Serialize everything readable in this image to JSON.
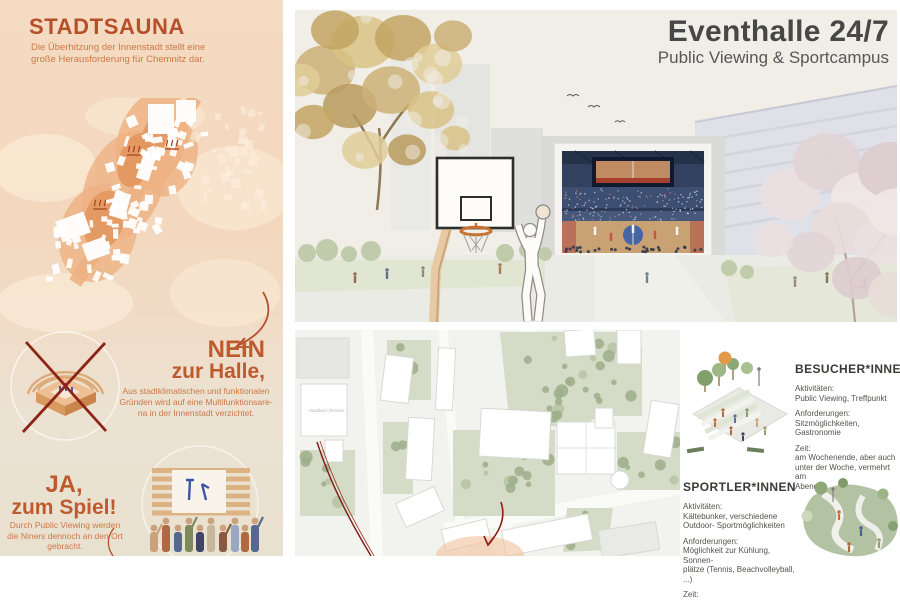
{
  "colors": {
    "accent_rust": "#b5502a",
    "accent_rust_light": "#cc7848",
    "cross_red": "#8c2417",
    "route_red": "#7d1a12",
    "title_gray": "#474747",
    "peach_background": "#f4d9c0",
    "sage_green": "#b3c2a3"
  },
  "left_panel": {
    "title": "STADTSAUNA",
    "subtitle_lines": [
      "Die Überhitzung der Innenstadt stellt eine",
      "große Herausforderung für Chemnitz dar."
    ],
    "nein": {
      "heading_line1": "NEIN",
      "heading_line2": "zur Halle,",
      "body_lines": [
        "Aus stadtklimatischen und funktionalen",
        "Gründen wird auf eine Multifunktionsare-",
        "na in der Innenstadt verzichtet."
      ]
    },
    "ja": {
      "heading_line1": "JA,",
      "heading_line2": "zum Spiel!",
      "body_lines": [
        "Durch Public Viewing werden",
        "die Niners dennoch an den Ort",
        "gebracht."
      ]
    }
  },
  "hero": {
    "title": "Eventhalle 24/7",
    "subtitle": "Public Viewing & Sportcampus"
  },
  "siteplan": {
    "building_label": "Stadtbad Chemnitz"
  },
  "personas": [
    {
      "heading": "BESUCHER*INNEN",
      "items": [
        {
          "label": "Aktivitäten:",
          "lines": [
            "Public Viewing, Treffpunkt"
          ]
        },
        {
          "label": "Anforderungen:",
          "lines": [
            "Sitzmöglichkeiten, Gastronomie"
          ]
        },
        {
          "label": "Zeit:",
          "lines": [
            "am Wochenende, aber auch",
            "unter der Woche, vermehrt am",
            "Abend"
          ]
        }
      ]
    },
    {
      "heading": "SPORTLER*INNEN",
      "items": [
        {
          "label": "Aktivitäten:",
          "lines": [
            "Kältebunker, verschiedene",
            "Outdoor- Sportmöglichkeiten"
          ]
        },
        {
          "label": "Anforderungen:",
          "lines": [
            "Möglichkeit zur Kühlung, Sonnen-",
            "plätze (Tennis, Beachvolleyball, ...)"
          ]
        },
        {
          "label": "Zeit:",
          "lines": []
        }
      ]
    }
  ]
}
